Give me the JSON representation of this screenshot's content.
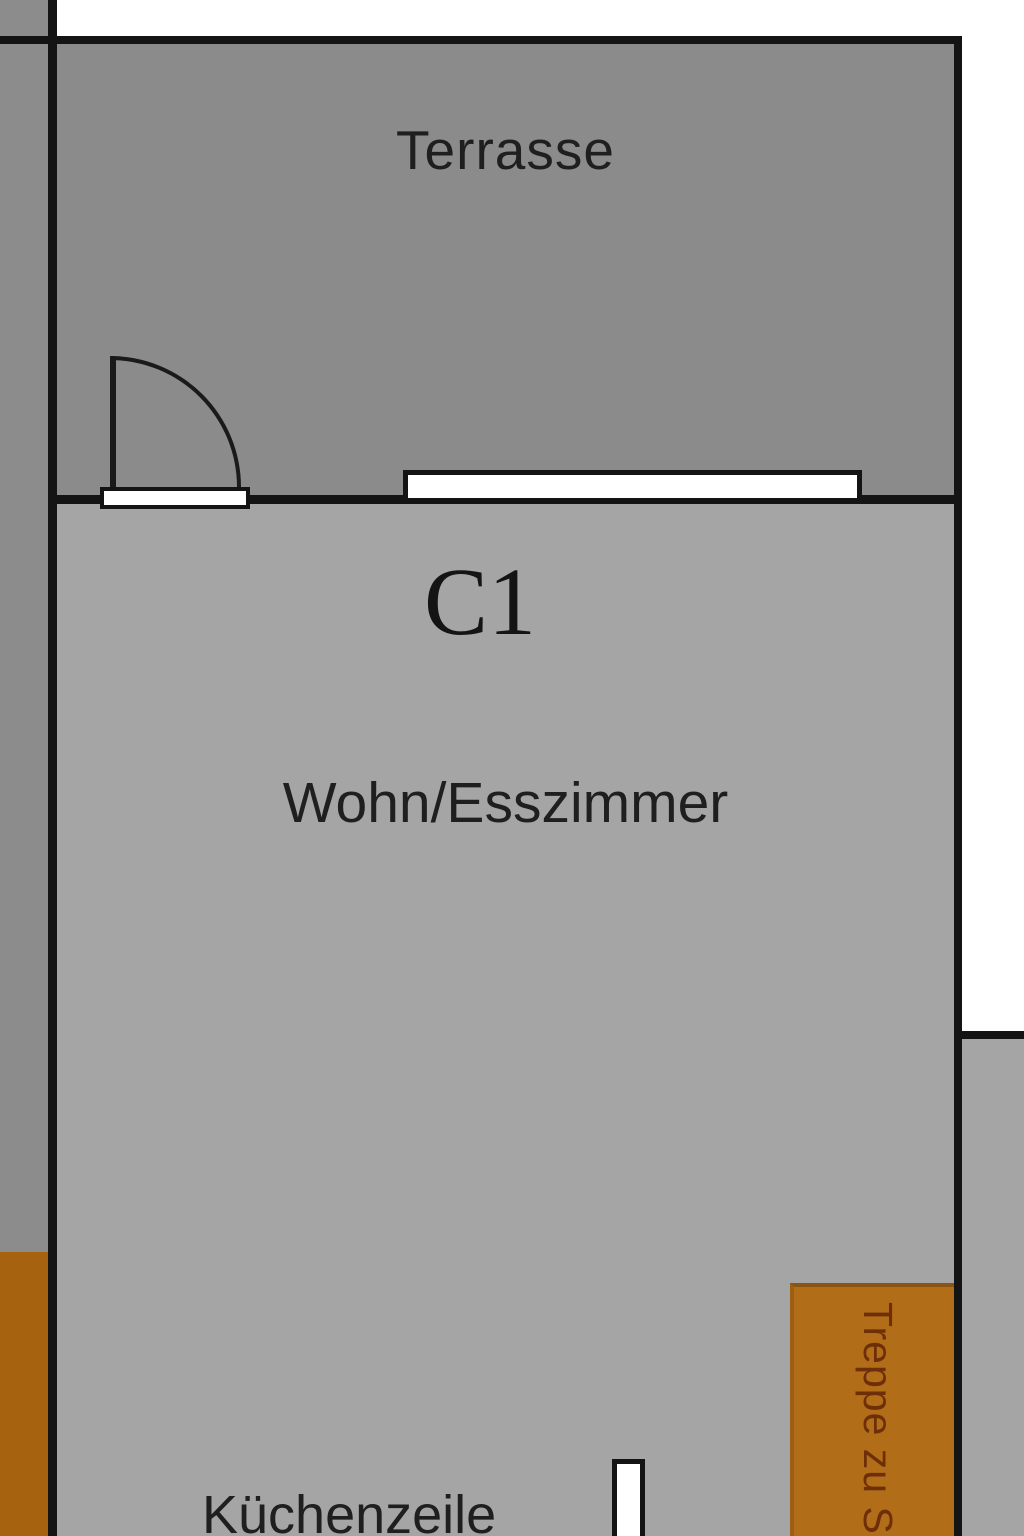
{
  "floorplan": {
    "unit_label": "C1",
    "rooms": {
      "terrace": {
        "label": "Terrasse"
      },
      "living_dining": {
        "label": "Wohn/Esszimmer"
      },
      "kitchenette": {
        "label": "Küchenzeile"
      },
      "stairs": {
        "label": "Treppe zu S"
      }
    },
    "symbols": {
      "door": "door-swing-arc",
      "window": "window-symbol",
      "kitchen": "kitchen-partition"
    },
    "colors": {
      "terrace_fill": "#8b8b8b",
      "living_fill": "#a5a5a5",
      "side_strip_fill": "#8c8c8c",
      "side_stairs_fill": "#a6620f",
      "stairs_fill": "#b16d18",
      "bottom_right_fill": "#a5a5a5",
      "wall_color": "#141414",
      "opening_fill": "#ffffff",
      "outside_fill": "#ffffff",
      "label_color": "#1f1f1f",
      "stairs_label_color": "#6e2f08"
    }
  }
}
